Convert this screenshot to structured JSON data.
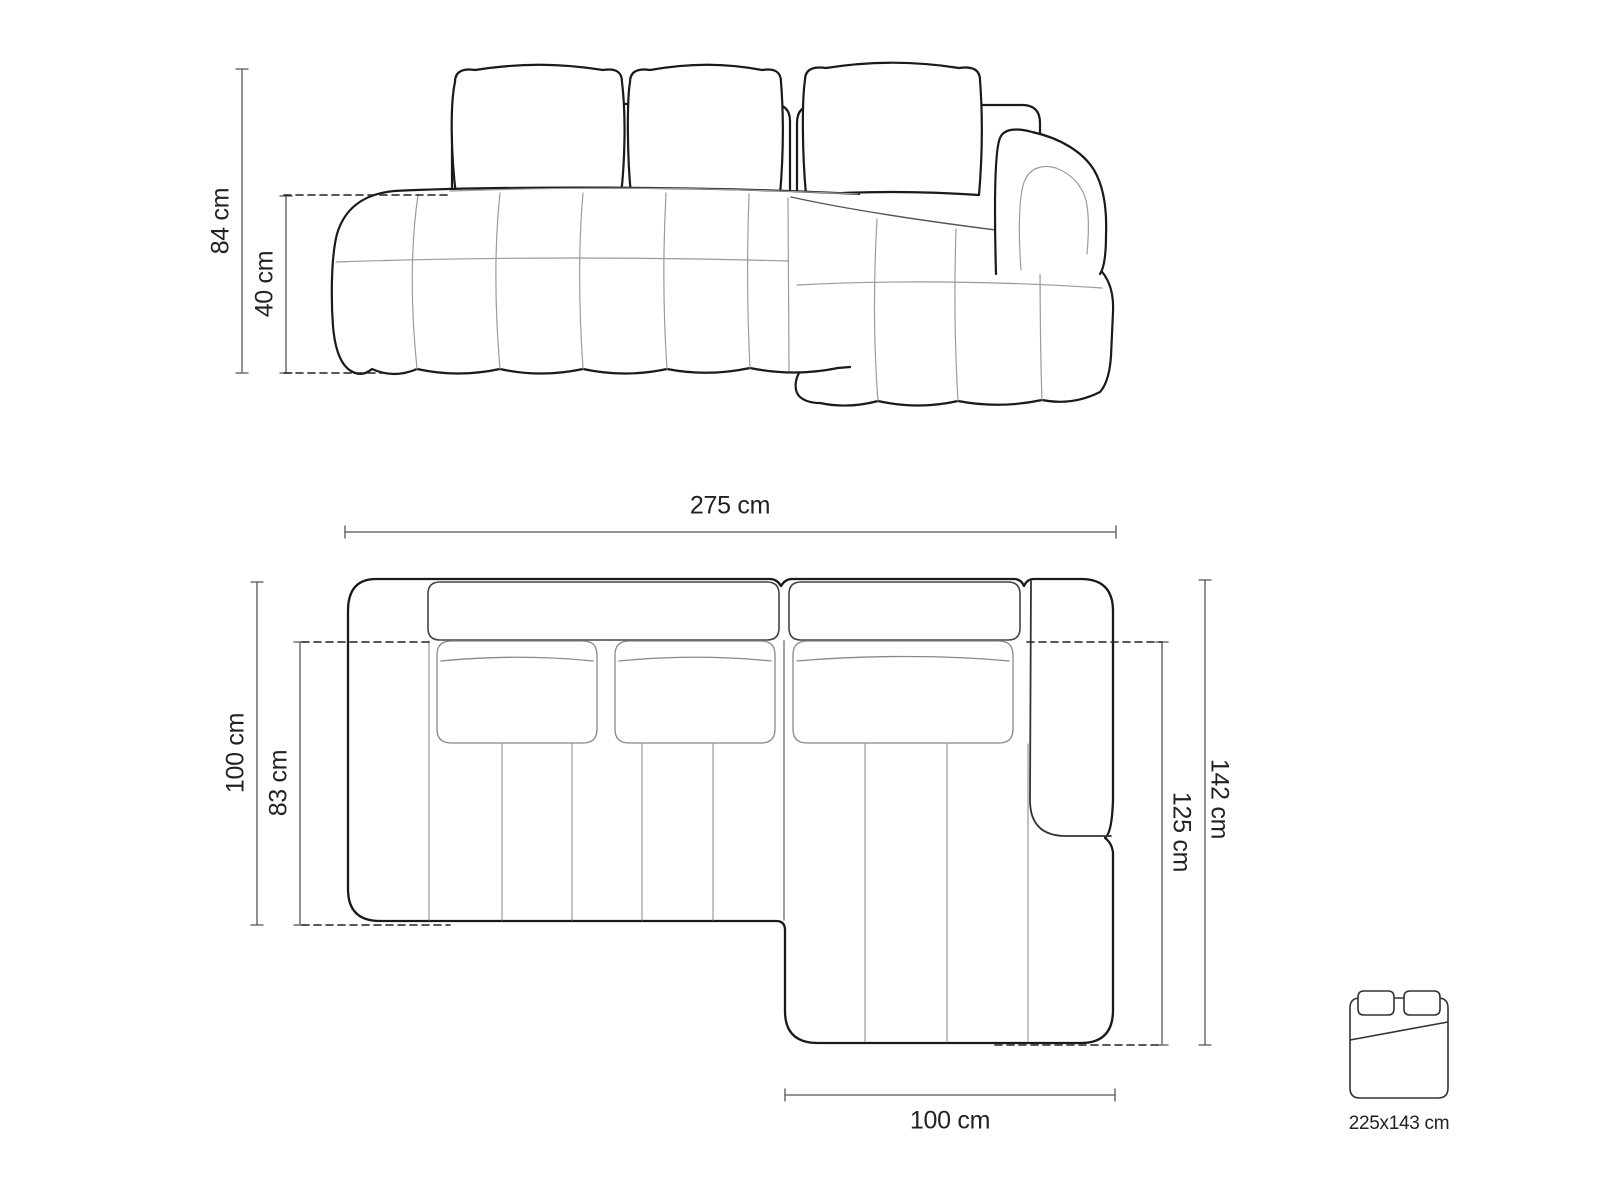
{
  "colors": {
    "background": "#ffffff",
    "outline": "#1a1a1a",
    "light_line": "#9a9a9a",
    "dimension_line": "#555555",
    "dashed_line": "#222222",
    "text": "#222222"
  },
  "front_view": {
    "total_height": {
      "label": "84 cm"
    },
    "seat_height": {
      "label": "40 cm"
    }
  },
  "top_view": {
    "total_width": {
      "label": "275 cm"
    },
    "total_depth": {
      "label": "100 cm"
    },
    "seat_depth": {
      "label": "83 cm"
    },
    "chaise_total_depth": {
      "label": "142 cm"
    },
    "chaise_inner_depth": {
      "label": "125 cm"
    },
    "chaise_width": {
      "label": "100 cm"
    }
  },
  "sleeping_area": {
    "icon": "bed-icon",
    "size_label": "225x143 cm"
  }
}
